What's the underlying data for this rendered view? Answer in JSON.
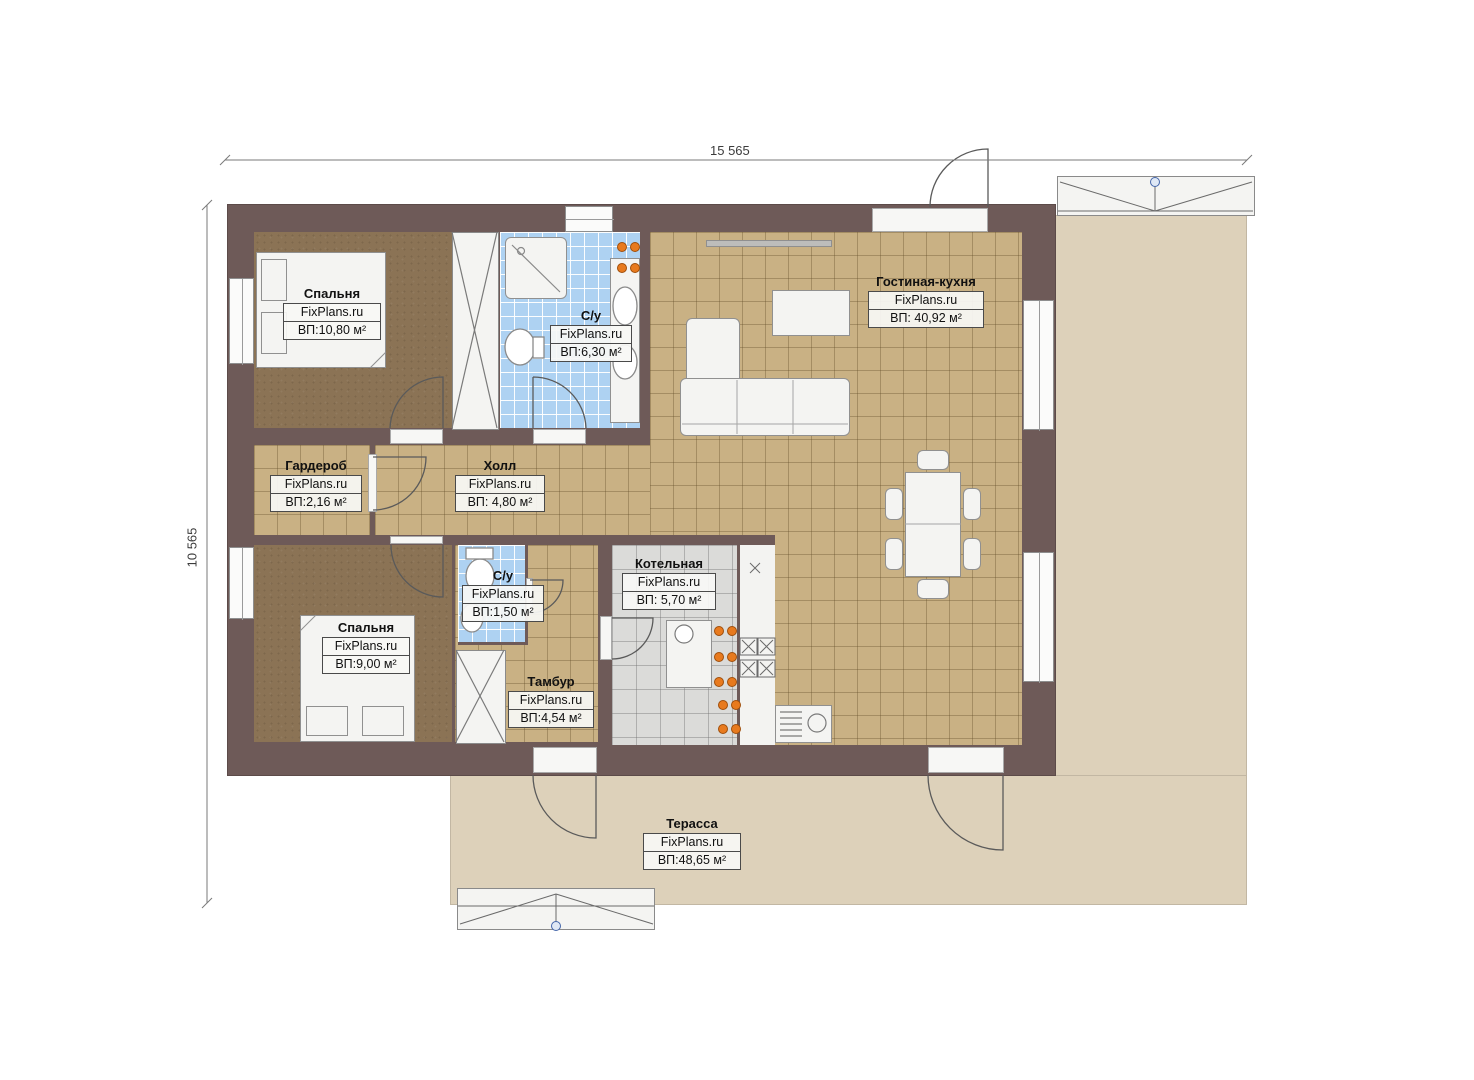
{
  "dimensions": {
    "top": "15 565",
    "left": "10 565"
  },
  "brand": "FixPlans.ru",
  "rooms": [
    {
      "name": "Спальня",
      "brand": "FixPlans.ru",
      "area": "ВП:10,80 м²"
    },
    {
      "name": "С/у",
      "brand": "FixPlans.ru",
      "area": "ВП:6,30 м²"
    },
    {
      "name": "Гостиная-кухня",
      "brand": "FixPlans.ru",
      "area": "ВП: 40,92 м²"
    },
    {
      "name": "Гардероб",
      "brand": "FixPlans.ru",
      "area": "ВП:2,16 м²"
    },
    {
      "name": "Холл",
      "brand": "FixPlans.ru",
      "area": "ВП: 4,80 м²"
    },
    {
      "name": "С/у",
      "brand": "FixPlans.ru",
      "area": "ВП:1,50 м²"
    },
    {
      "name": "Котельная",
      "brand": "FixPlans.ru",
      "area": "ВП: 5,70 м²"
    },
    {
      "name": "Спальня",
      "brand": "FixPlans.ru",
      "area": "ВП:9,00 м²"
    },
    {
      "name": "Тамбур",
      "brand": "FixPlans.ru",
      "area": "ВП:4,54 м²"
    },
    {
      "name": "Терасса",
      "brand": "FixPlans.ru",
      "area": "ВП:48,65 м²"
    }
  ],
  "colors": {
    "wall": "#6e5a58",
    "bedroom_floor": "#8b7355",
    "tile_tan": "#c9b184",
    "tile_blue": "#aed2f2",
    "tile_gray": "#dbdbd9",
    "terrace": "#ddd1ba",
    "accent_orange": "#e87a1e"
  }
}
